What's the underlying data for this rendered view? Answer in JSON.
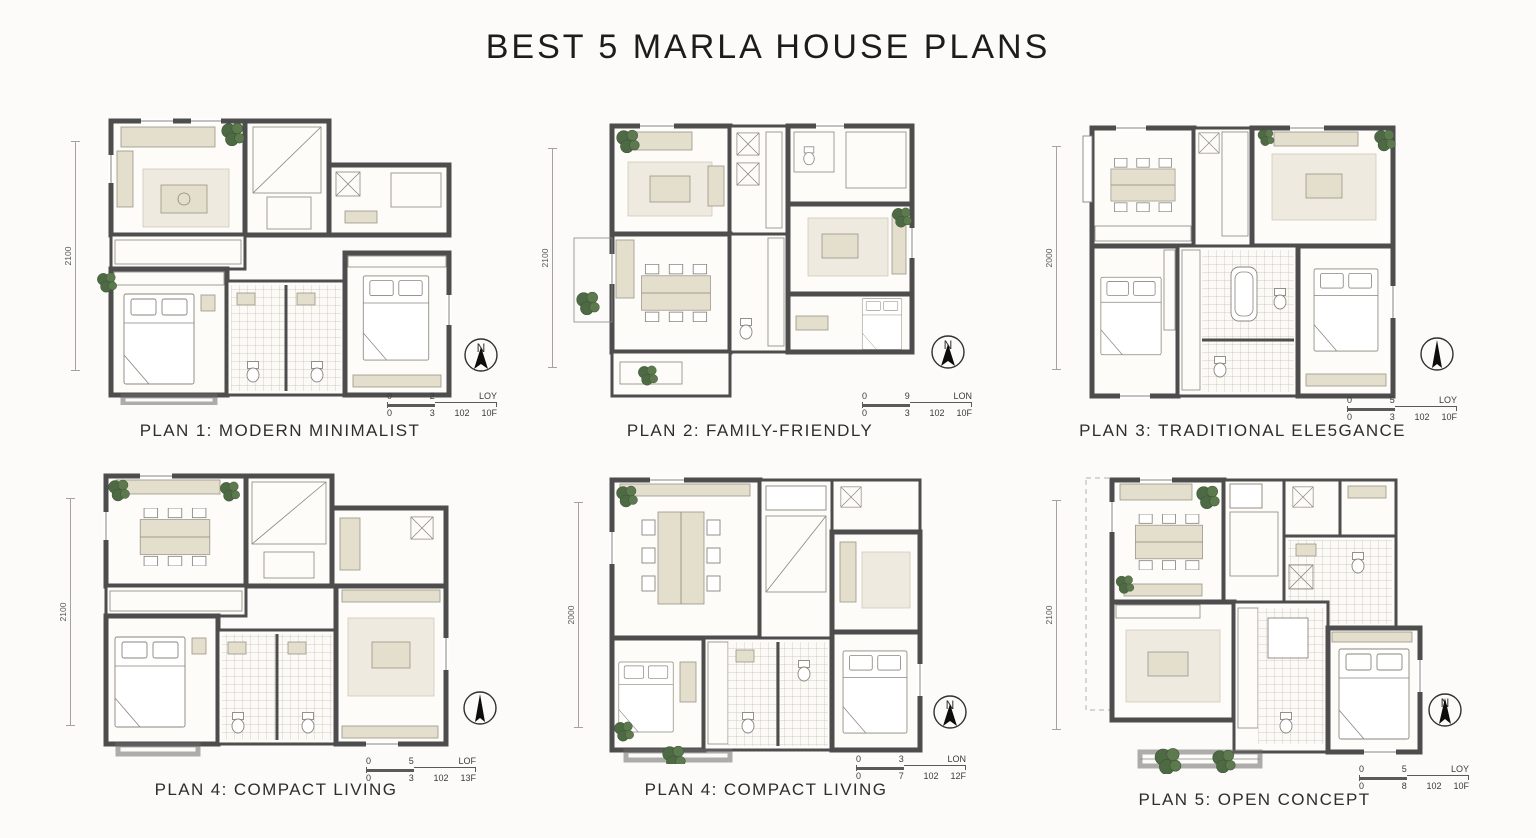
{
  "page": {
    "title": "BEST 5 MARLA HOUSE PLANS"
  },
  "colors": {
    "wall": "#4d4d4d",
    "furniture": "#e4decd",
    "rug": "#eeeadf",
    "plant": "#4e6a44",
    "paper": "#fcfbf9",
    "text": "#2b2b2b"
  },
  "plans": [
    {
      "caption": "PLAN 1: MODERN MINIMALIST",
      "dimension": "2100",
      "compass_letter": "N",
      "scale": {
        "top": [
          "0",
          "2",
          "LOY"
        ],
        "bottom": [
          "0",
          "3",
          "102",
          "10F"
        ]
      }
    },
    {
      "caption": "PLAN 2: FAMILY-FRIENDLY",
      "dimension": "2100",
      "compass_letter": "N",
      "scale": {
        "top": [
          "0",
          "9",
          "LON"
        ],
        "bottom": [
          "0",
          "3",
          "102",
          "10F"
        ]
      }
    },
    {
      "caption": "PLAN 3: TRADITIONAL ELE5GANCE",
      "dimension": "2000",
      "compass_letter": "",
      "scale": {
        "top": [
          "0",
          "5",
          "LOY"
        ],
        "bottom": [
          "0",
          "3",
          "102",
          "10F"
        ]
      }
    },
    {
      "caption": "PLAN 4: COMPACT LIVING",
      "dimension": "2100",
      "compass_letter": "",
      "scale": {
        "top": [
          "0",
          "5",
          "LOF"
        ],
        "bottom": [
          "0",
          "3",
          "102",
          "13F"
        ]
      }
    },
    {
      "caption": "PLAN 4: COMPACT LIVING",
      "dimension": "2000",
      "compass_letter": "N",
      "scale": {
        "top": [
          "0",
          "3",
          "LON"
        ],
        "bottom": [
          "0",
          "7",
          "102",
          "12F"
        ]
      }
    },
    {
      "caption": "PLAN 5: OPEN CONCEPT",
      "dimension": "2100",
      "compass_letter": "N",
      "scale": {
        "top": [
          "0",
          "5",
          "LOY"
        ],
        "bottom": [
          "0",
          "8",
          "102",
          "10F"
        ]
      }
    }
  ]
}
